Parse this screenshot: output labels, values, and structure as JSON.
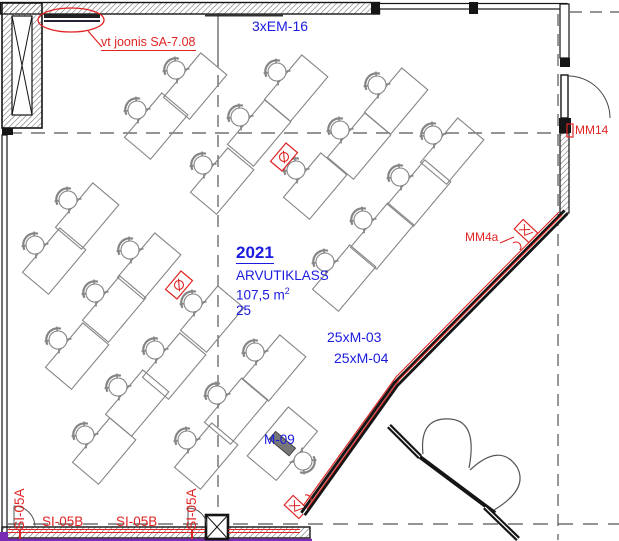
{
  "room": {
    "number": "2021",
    "name": "ARVUTIKLASS",
    "area_base": "107,5 m",
    "area_sup": "2",
    "capacity": "25"
  },
  "annotations": {
    "cable_top": "3xEM-16",
    "ref_drawing": "vt joonis SA-7.08",
    "monitors_1": "25xM-03",
    "monitors_2": "25xM-04",
    "teacher_unit": "M-09",
    "device_wall": "MM4a",
    "device_door": "MM14",
    "trunking_b1": "SI-05B",
    "trunking_b2": "SI-05B",
    "riser_a1": "SI-05A",
    "riser_a2": "SI-05A"
  },
  "colors": {
    "annotation_blue": "#1b1be0",
    "annotation_red": "#e02424",
    "furniture_gray": "#858585",
    "wall_black": "#151515",
    "trunking_purple": "#7a2bb5"
  },
  "furniture": {
    "desk_size": {
      "length": 58,
      "depth": 34
    },
    "default_rotation": -50,
    "desks": [
      {
        "x": 176,
        "y": 70
      },
      {
        "x": 137,
        "y": 110
      },
      {
        "x": 277,
        "y": 72
      },
      {
        "x": 240,
        "y": 117
      },
      {
        "x": 203,
        "y": 165
      },
      {
        "x": 377,
        "y": 85
      },
      {
        "x": 340,
        "y": 130
      },
      {
        "x": 296,
        "y": 170
      },
      {
        "x": 433,
        "y": 135
      },
      {
        "x": 400,
        "y": 177
      },
      {
        "x": 363,
        "y": 220
      },
      {
        "x": 325,
        "y": 262
      },
      {
        "x": 68,
        "y": 200
      },
      {
        "x": 35,
        "y": 245
      },
      {
        "x": 130,
        "y": 250
      },
      {
        "x": 95,
        "y": 293
      },
      {
        "x": 58,
        "y": 340
      },
      {
        "x": 193,
        "y": 303
      },
      {
        "x": 155,
        "y": 350
      },
      {
        "x": 118,
        "y": 387
      },
      {
        "x": 85,
        "y": 435
      },
      {
        "x": 255,
        "y": 352
      },
      {
        "x": 217,
        "y": 395
      },
      {
        "x": 187,
        "y": 440
      }
    ],
    "teacher_desk": {
      "x": 303,
      "y": 461,
      "rotation": 130,
      "length": 64,
      "depth": 38
    },
    "outlets": [
      {
        "x": 284,
        "y": 157,
        "rotation": -50
      },
      {
        "x": 179,
        "y": 285,
        "rotation": -50
      }
    ],
    "speakers": [
      {
        "x": 526,
        "y": 231,
        "rotation": 43
      },
      {
        "x": 296,
        "y": 507,
        "rotation": 43
      }
    ]
  }
}
